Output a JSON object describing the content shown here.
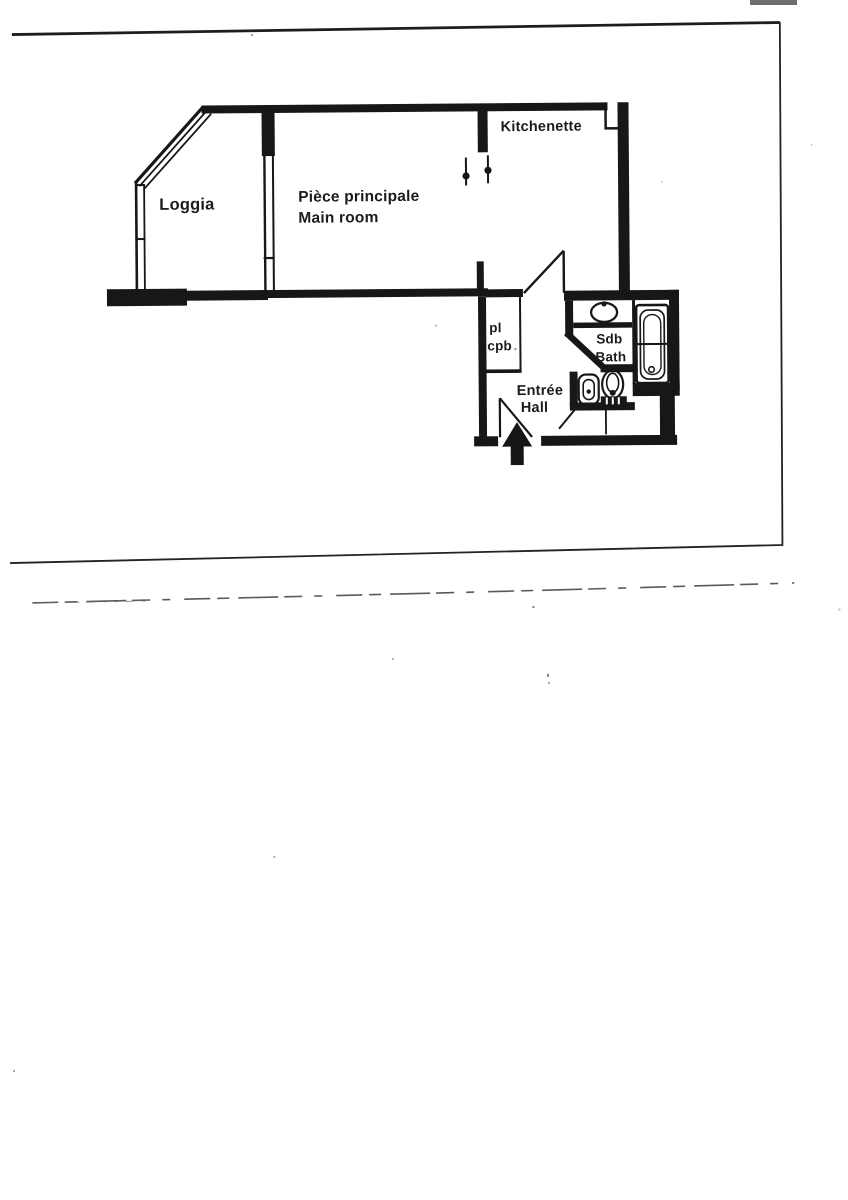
{
  "scan": {
    "paper_color": "#ffffff",
    "ink_color": "#171717",
    "artifact_bar_color": "#6f6f6f"
  },
  "floor_plan": {
    "rooms": {
      "loggia": {
        "label": "Loggia"
      },
      "main_room": {
        "label_fr": "Pièce principale",
        "label_en": "Main room"
      },
      "kitchenette": {
        "label": "Kitchenette"
      },
      "closet": {
        "label_line1": "pl",
        "label_line2": "cpb"
      },
      "bathroom": {
        "label_fr": "Sdb",
        "label_en": "Bath"
      },
      "entrance": {
        "label_fr": "Entrée",
        "label_en": "Hall"
      }
    },
    "fixtures": [
      "washbasin",
      "bathtub",
      "bidet",
      "toilet",
      "kitchen-connection-symbols",
      "entrance-arrow",
      "door-swings",
      "window-glazing"
    ]
  }
}
